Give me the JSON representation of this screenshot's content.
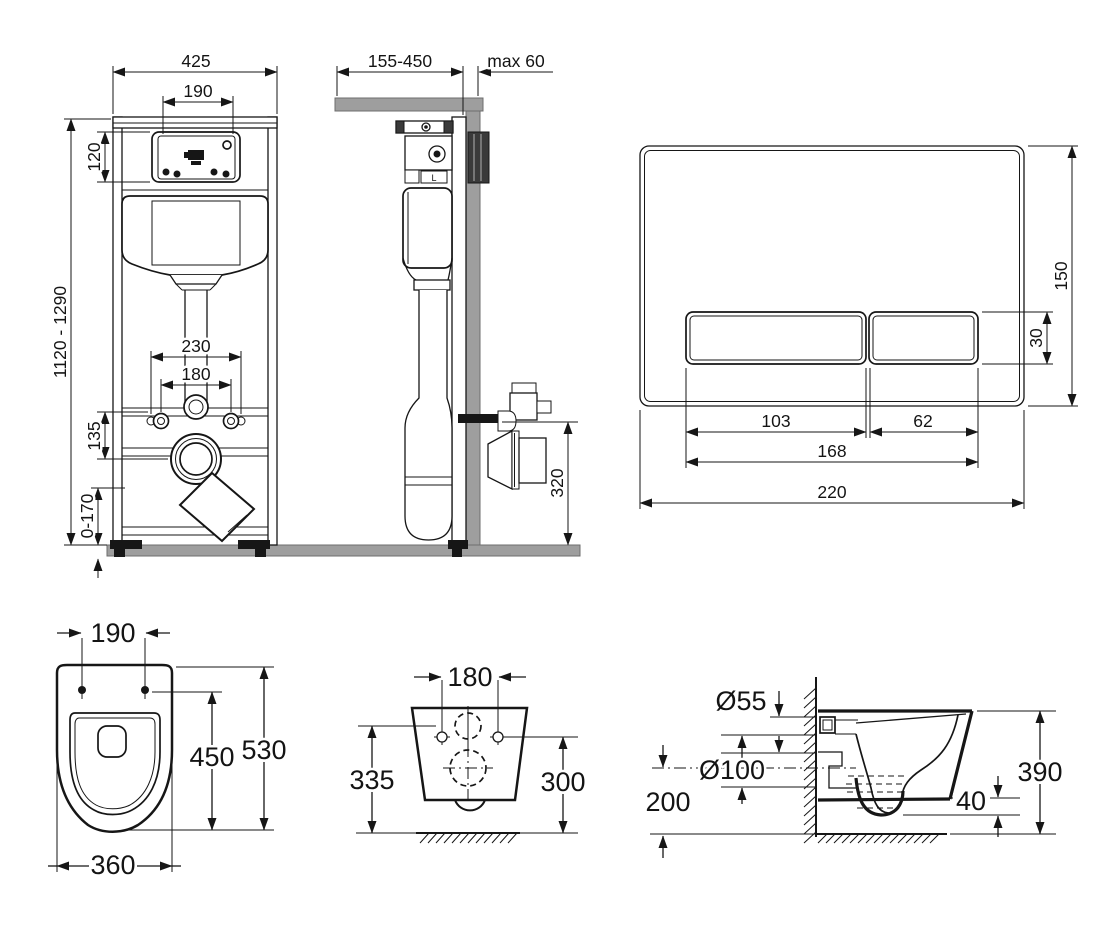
{
  "document": {
    "background": "#ffffff",
    "line_color": "#161616",
    "surface_gray": "#9e9e9e"
  },
  "views": {
    "frame_front": {
      "dims": {
        "width": "425",
        "opening_width": "190",
        "opening_height": "120",
        "height_range": "1120 - 1290",
        "outer_fixing_spacing": "230",
        "bolt_spacing": "180",
        "outlet_offset": "135",
        "foot_adjustment": "0-170"
      }
    },
    "frame_side": {
      "dims": {
        "depth_range": "155-450",
        "finish_max": "max 60",
        "supply_height": "320"
      },
      "marking": "L"
    },
    "flush_plate": {
      "dims": {
        "height": "150",
        "button_height": "30",
        "large_button_width": "103",
        "small_button_width": "62",
        "buttons_width": "168",
        "width": "220"
      }
    },
    "bowl_top": {
      "dims": {
        "hole_spacing": "190",
        "holes_to_front": "450",
        "depth": "530",
        "width": "360"
      }
    },
    "bowl_rear": {
      "dims": {
        "hole_spacing": "180",
        "left_height": "335",
        "right_height": "300"
      }
    },
    "bowl_side": {
      "dims": {
        "inlet_diameter": "Ø55",
        "outlet_diameter": "Ø100",
        "outlet_height": "200",
        "undercut": "40",
        "height": "390"
      }
    }
  }
}
